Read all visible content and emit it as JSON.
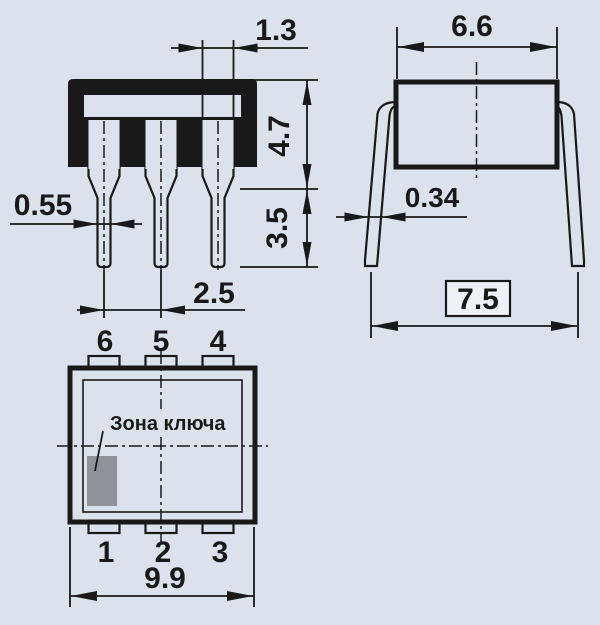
{
  "drawing_title": "component-package-outline-drawing",
  "colors": {
    "background": "#dbe2ec",
    "ink": "#191919",
    "key_zone_fill": "#909297",
    "ref_box_fill": "#eef1f7"
  },
  "dimensions": {
    "shoulder_width": "1.3",
    "body_depth": "6.6",
    "body_height": "4.7",
    "lead_width": "0.55",
    "lead_length": "3.5",
    "lead_pitch": "2.5",
    "lead_thickness": "0.34",
    "lead_span": "7.5",
    "body_length": "9.9"
  },
  "pins": {
    "top": [
      "6",
      "5",
      "4"
    ],
    "bottom": [
      "1",
      "2",
      "3"
    ]
  },
  "labels": {
    "key_zone": "Зона ключа"
  }
}
